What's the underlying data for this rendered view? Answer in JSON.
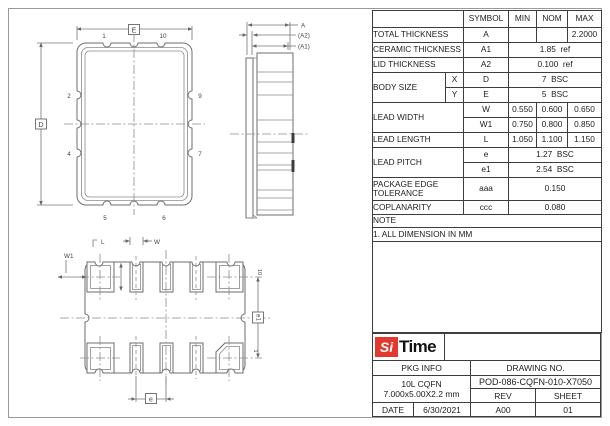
{
  "colors": {
    "logo_red": "#e4372e",
    "line_gray": "#6e6e6e"
  },
  "table": {
    "headers": {
      "symbol": "SYMBOL",
      "min": "MIN",
      "nom": "NOM",
      "max": "MAX"
    },
    "rows": [
      {
        "name": "TOTAL THICKNESS",
        "symbol": "A",
        "min": "",
        "nom": "",
        "max": "2.2000"
      },
      {
        "name": "CERAMIC THICKNESS",
        "symbol": "A1",
        "span": "1.85  ref"
      },
      {
        "name": "LID THICKNESS",
        "symbol": "A2",
        "span": "0.100  ref"
      },
      {
        "name": "BODY SIZE",
        "sub": "X",
        "symbol": "D",
        "span": "7  BSC"
      },
      {
        "sub": "Y",
        "symbol": "E",
        "span": "5  BSC"
      },
      {
        "name": "LEAD WIDTH",
        "symbol": "W",
        "min": "0.550",
        "nom": "0.600",
        "max": "0.650"
      },
      {
        "symbol": "W1",
        "min": "0.750",
        "nom": "0.800",
        "max": "0.850"
      },
      {
        "name": "LEAD LENGTH",
        "symbol": "L",
        "min": "1.050",
        "nom": "1.100",
        "max": "1.150"
      },
      {
        "name": "LEAD PITCH",
        "symbol": "e",
        "span": "1.27  BSC"
      },
      {
        "symbol": "e1",
        "span": "2.54  BSC"
      },
      {
        "name": "PACKAGE EDGE TOLERANCE",
        "symbol": "aaa",
        "span": "0.150"
      },
      {
        "name": "COPLANARITY",
        "symbol": "ccc",
        "span": "0.080"
      }
    ],
    "note_label": "NOTE",
    "note_1": "1. ALL DIMENSION IN MM"
  },
  "title_block": {
    "logo_si": "Si",
    "logo_time": "Time",
    "pkg_info_label": "PKG INFO",
    "drawing_no_label": "DRAWING NO.",
    "pkg_name": "10L CQFN",
    "pkg_dims": "7.000x5.00X2.2 mm",
    "drawing_no": "POD-086-CQFN-010-X7050",
    "rev_label": "REV",
    "sheet_label": "SHEET",
    "date_label": "DATE",
    "date": "6/30/2021",
    "rev": "A00",
    "sheet": "01"
  },
  "drawings": {
    "top_view": {
      "dim_horizontal": "E",
      "dim_vertical": "D",
      "pins": {
        "top_left": "1",
        "top_right": "10",
        "left_upper": "2",
        "right_upper": "9",
        "left_lower": "4",
        "right_lower": "7",
        "bottom_left": "5",
        "bottom_right": "6"
      }
    },
    "side_view": {
      "dim_a": "A",
      "dim_a2": "(A2)",
      "dim_a1": "(A1)"
    },
    "bottom_view": {
      "dim_w1": "W1",
      "dim_l": "L",
      "dim_w": "W",
      "dim_e": "e",
      "dim_e1": "e1",
      "pin_top_right": "10",
      "pin_bottom_right": "1"
    }
  }
}
